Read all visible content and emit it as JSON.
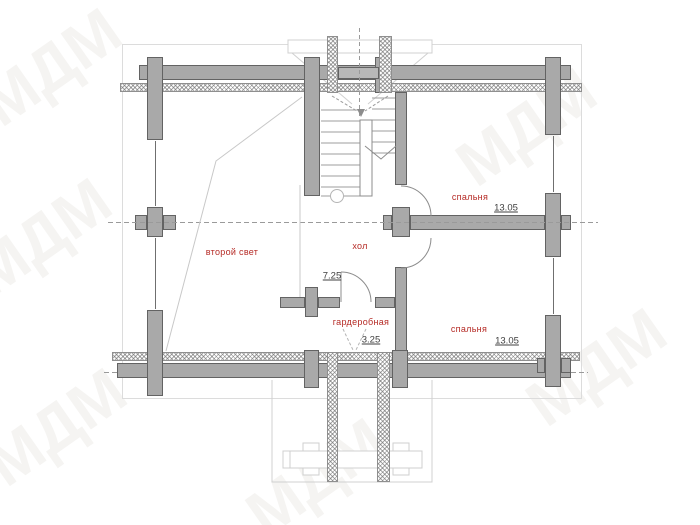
{
  "watermark": {
    "text": "МДМ"
  },
  "rooms": [
    {
      "id": "second-light",
      "label": "второй свет",
      "area": ""
    },
    {
      "id": "hall",
      "label": "хол",
      "area": "7.25"
    },
    {
      "id": "bedroom-top",
      "label": "спальня",
      "area": "13.05"
    },
    {
      "id": "bedroom-bottom",
      "label": "спальня",
      "area": "13.05"
    },
    {
      "id": "wardrobe",
      "label": "гардеробная",
      "area": "3.25"
    }
  ],
  "colors": {
    "wall": "#a9a9a9",
    "outline": "#636363",
    "red": "#b52a25",
    "dim": "#3f3f3f"
  }
}
